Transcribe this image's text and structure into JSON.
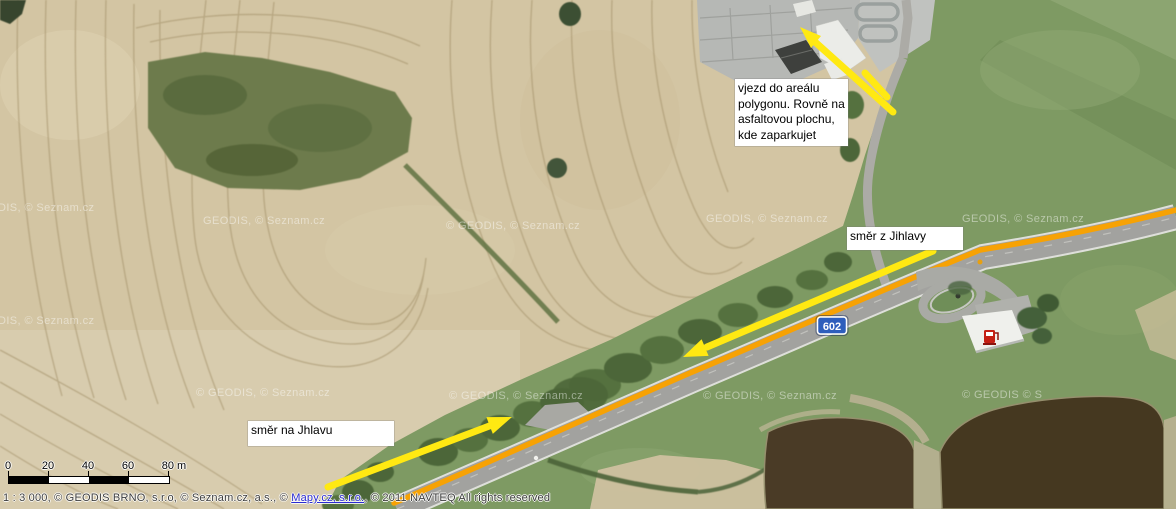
{
  "map": {
    "annotations": {
      "entry_note": {
        "lines": [
          "vjezd do areálu",
          "polygonu. Rovně na",
          "asfaltovou plochu,",
          "kde zaparkujet"
        ]
      },
      "from_jihlava": {
        "text": "směr z Jihlavy"
      },
      "to_jihlava": {
        "text": "směr na Jhlavu"
      }
    },
    "road_shield": {
      "number": "602"
    },
    "watermarks": [
      {
        "text": "DIS, © Seznam.cz",
        "x": -2,
        "y": 211
      },
      {
        "text": "GEODIS, © Seznam.cz",
        "x": 203,
        "y": 224
      },
      {
        "text": "© GEODIS, © Seznam.cz",
        "x": 446,
        "y": 229
      },
      {
        "text": "GEODIS, © Seznam.cz",
        "x": 706,
        "y": 222
      },
      {
        "text": "GEODIS, © Seznam.cz",
        "x": 962,
        "y": 222
      },
      {
        "text": "DIS, © Seznam.cz",
        "x": -2,
        "y": 324
      },
      {
        "text": "© GEODIS, © Seznam.cz",
        "x": 196,
        "y": 396
      },
      {
        "text": "© GEODIS, © Seznam.cz",
        "x": 449,
        "y": 399
      },
      {
        "text": "© GEODIS, © Seznam.cz",
        "x": 703,
        "y": 399
      },
      {
        "text": "© GEODIS © S",
        "x": 962,
        "y": 398
      }
    ],
    "scalebar": {
      "labels": [
        {
          "text": "0",
          "x": 8
        },
        {
          "text": "20",
          "x": 48
        },
        {
          "text": "40",
          "x": 88
        },
        {
          "text": "60",
          "x": 128
        },
        {
          "text": "80 m",
          "x": 174
        }
      ],
      "tick_x": [
        8,
        48,
        88,
        128,
        168
      ]
    },
    "attribution": {
      "prefix": "1 : 3 000, © GEODIS BRNO, s.r.o, © Seznam.cz, a.s., © ",
      "link": "Mapy.cz, s.r.o.",
      "suffix": ", © 2011 NAVTEQ All rights reserved"
    }
  },
  "colors": {
    "arrow_yellow": "#ffe912",
    "route_orange": "#f7a204",
    "shield_blue": "#2e5ebc",
    "link_blue": "#2b2bd0",
    "watermark_color": "rgba(255,255,255,0.45)"
  }
}
